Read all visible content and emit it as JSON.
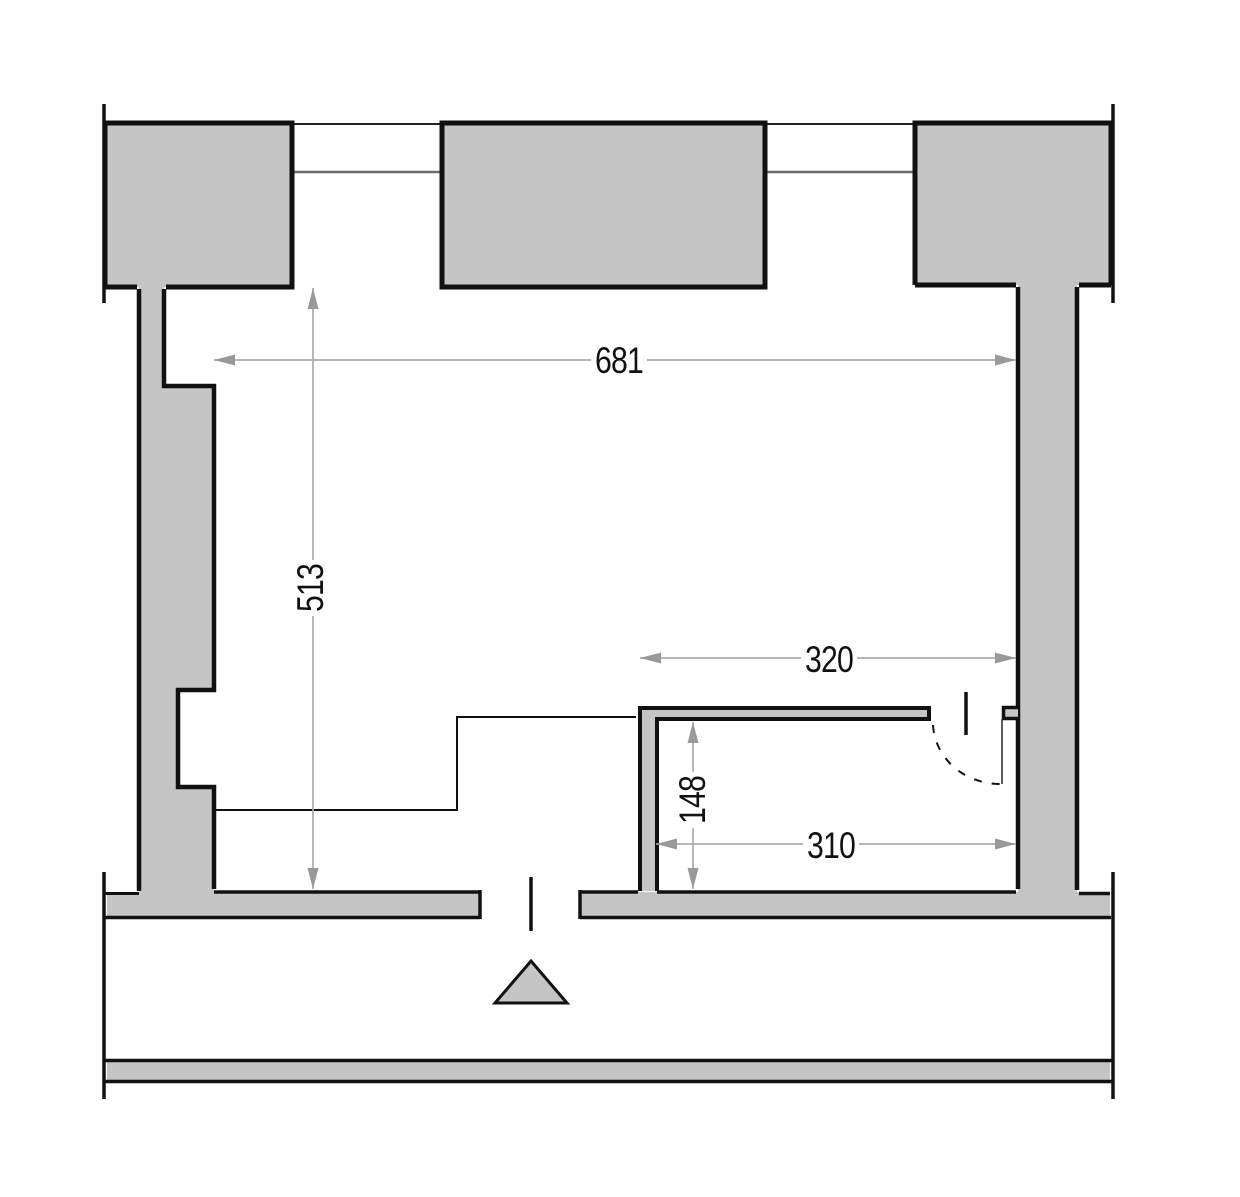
{
  "plan": {
    "type": "floor-plan",
    "dimensions": [
      {
        "id": "room-width-top",
        "value": "681",
        "orientation": "horizontal"
      },
      {
        "id": "room-height-left",
        "value": "513",
        "orientation": "vertical"
      },
      {
        "id": "alcove-width-top",
        "value": "320",
        "orientation": "horizontal"
      },
      {
        "id": "alcove-height",
        "value": "148",
        "orientation": "vertical"
      },
      {
        "id": "alcove-width-bottom",
        "value": "310",
        "orientation": "horizontal"
      }
    ],
    "symbols": [
      {
        "name": "entrance-triangle",
        "meaning": "entrance marker at bottom door"
      },
      {
        "name": "door-swing-arc",
        "meaning": "dashed swing arc of interior door"
      },
      {
        "name": "door-center-marker",
        "meaning": "perpendicular line through door opening"
      }
    ],
    "colors": {
      "wall_fill": "#c5c5c5",
      "wall_outline": "#111111",
      "window_line": "#6a6a6a",
      "dimension_line": "#ababab",
      "dimension_arrow": "#999999",
      "dimension_text": "#111111",
      "background": "#ffffff"
    }
  }
}
